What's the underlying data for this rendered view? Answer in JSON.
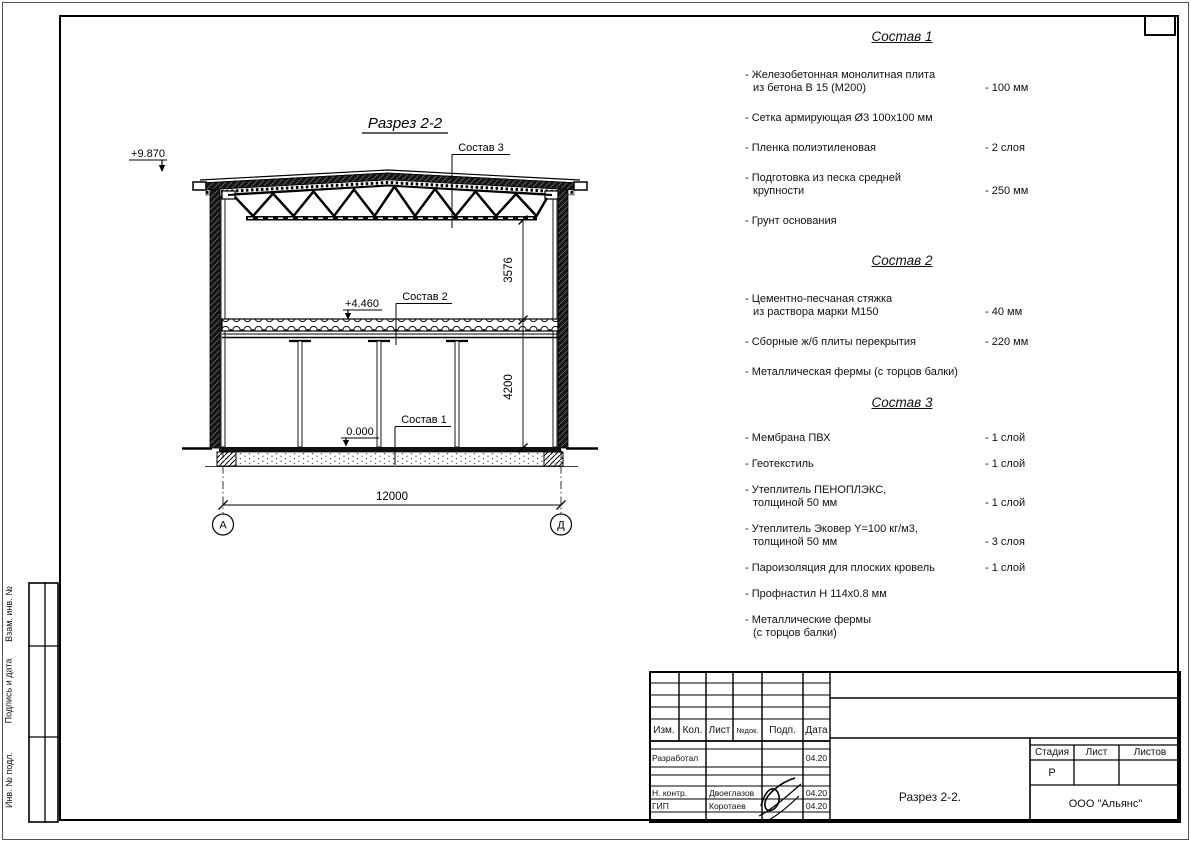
{
  "drawing": {
    "title": "Разрез 2-2",
    "elevations": {
      "roof": "+9.870",
      "floor": "+4.460",
      "ground": "0.000"
    },
    "labels": {
      "sostav1": "Состав 1",
      "sostav2": "Состав 2",
      "sostav3": "Состав 3"
    },
    "dimensions": {
      "truss_height": "3576",
      "floor_height": "4200",
      "span": "12000"
    },
    "axes": {
      "left": "А",
      "right": "Д"
    }
  },
  "compositions": [
    {
      "title": "Состав 1",
      "items": [
        {
          "t": "- Железобетонная  монолитная плита",
          "t2": "из бетона В 15 (М200)",
          "v": "- 100 мм"
        },
        {
          "t": "- Сетка армирующая Ø3 100х100 мм"
        },
        {
          "t": "- Пленка полиэтиленовая",
          "v": "- 2 слоя"
        },
        {
          "t": "- Подготовка из песка средней",
          "t2": "крупности",
          "v": "- 250 мм"
        },
        {
          "t": "- Грунт основания"
        }
      ]
    },
    {
      "title": "Состав 2",
      "items": [
        {
          "t": "- Цементно-песчаная стяжка",
          "t2": "из раствора марки М150",
          "v": "- 40 мм"
        },
        {
          "t": "- Сборные ж/б плиты перекрытия",
          "v": "- 220 мм"
        },
        {
          "t": "- Металлическая фермы (с торцов балки)"
        }
      ]
    },
    {
      "title": "Состав 3",
      "items": [
        {
          "t": "- Мембрана ПВХ",
          "v": "- 1 слой"
        },
        {
          "t": "- Геотекстиль",
          "v": "- 1 слой"
        },
        {
          "t": "- Утеплитель ПЕНОПЛЭКС,",
          "t2": "толщиной 50 мм",
          "v": "- 1 слой"
        },
        {
          "t": "- Утеплитель Эковер Y=100 кг/м3,",
          "t2": "толщиной 50 мм",
          "v": "- 3 слоя"
        },
        {
          "t": "- Пароизоляция для плоских кровель",
          "v": "- 1 слой"
        },
        {
          "t": "- Профнастил Н 114х0.8 мм"
        },
        {
          "t": "- Металлические фермы",
          "t2": "(с торцов балки)"
        }
      ]
    }
  ],
  "title_block": {
    "header": {
      "izm": "Изм.",
      "kol": "Кол.",
      "list": "Лист",
      "ndok": "№док.",
      "podp": "Подп.",
      "data": "Дата"
    },
    "rows": [
      {
        "role": "Разработал",
        "name": "",
        "date": "04.20"
      },
      {
        "role": "Н. контр.",
        "name": "Двоеглазов",
        "date": "04.20"
      },
      {
        "role": "ГИП",
        "name": "Коротаев",
        "date": "04.20"
      }
    ],
    "doc_title": "Разрез 2-2.",
    "stage_label": "Стадия",
    "sheet_label": "Лист",
    "sheets_label": "Листов",
    "stage_value": "Р",
    "company": "ООО \"Альянс\""
  },
  "side_stamps": {
    "top": "Взам. инв. №",
    "middle": "Подпись и дата",
    "bottom": "Инв. № подл."
  }
}
